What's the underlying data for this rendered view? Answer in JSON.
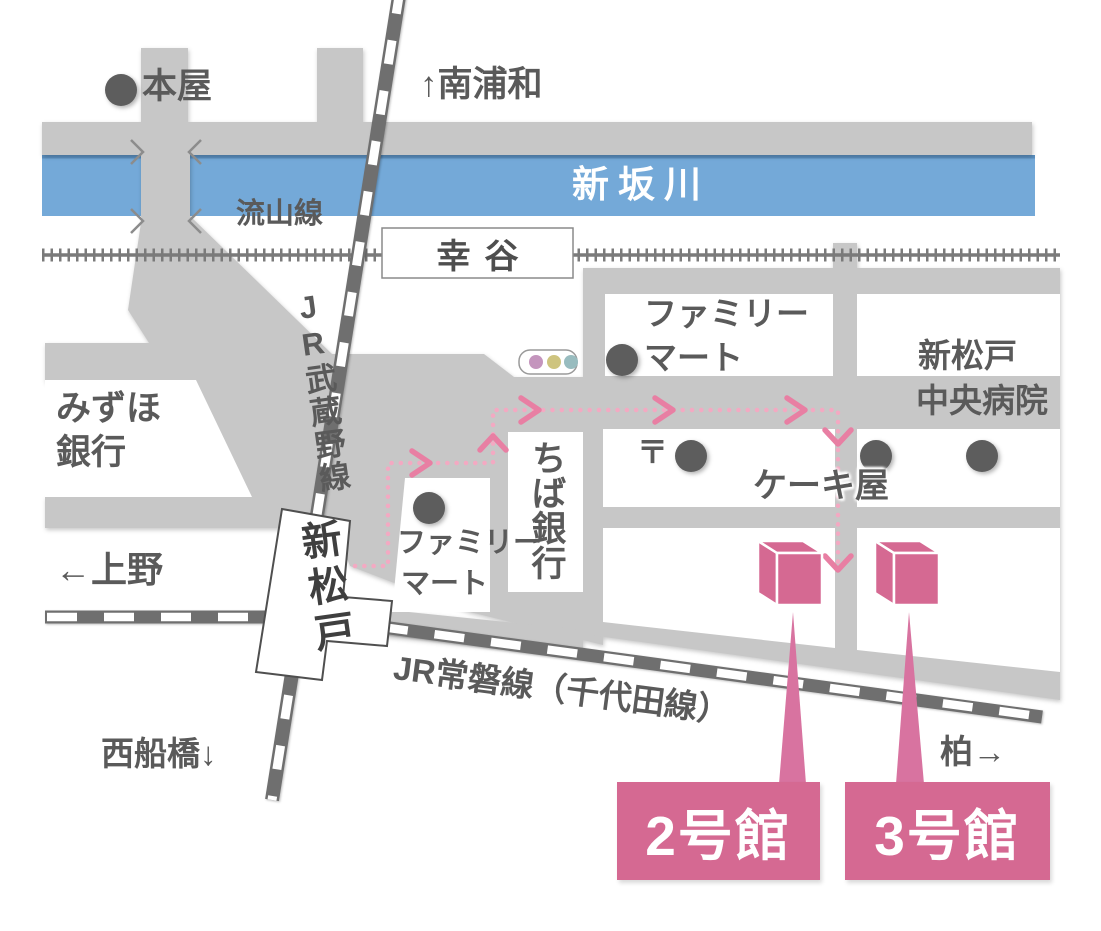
{
  "labels": {
    "bookstore": "本屋",
    "dir_minami_urawa": "↑南浦和",
    "river_name": "新坂川",
    "nagareyama_line": "流山線",
    "koya_station": "幸谷",
    "mizuho_line1": "みずほ",
    "mizuho_line2": "銀行",
    "jr_musashino_line": "JR武蔵野線",
    "familymart_north_line1": "ファミリー",
    "familymart_north_line2": "マート",
    "hospital_line1": "新松戸",
    "hospital_line2": "中央病院",
    "chiba_bank": "ちば銀行",
    "post_mark": "〒",
    "cake_shop": "ケーキ屋",
    "familymart_west_line1": "ファミリー",
    "familymart_west_line2": "マート",
    "station_shin_matsudo": "新松戸",
    "dir_ueno": "←上野",
    "jr_joban_line": "JR常磐線（千代田線）",
    "dir_nishi_funabashi": "西船橋↓",
    "dir_kashiwa": "柏→",
    "building_2": "2号館",
    "building_3": "3号館"
  },
  "colors": {
    "road_gray": "#c7c7c7",
    "river_blue": "#74a9d8",
    "accent_pink": "#d56992",
    "route_dot_pink": "#f3a9c2",
    "rail_dark": "#6f6f6f",
    "text_gray": "#5a5a5a"
  }
}
